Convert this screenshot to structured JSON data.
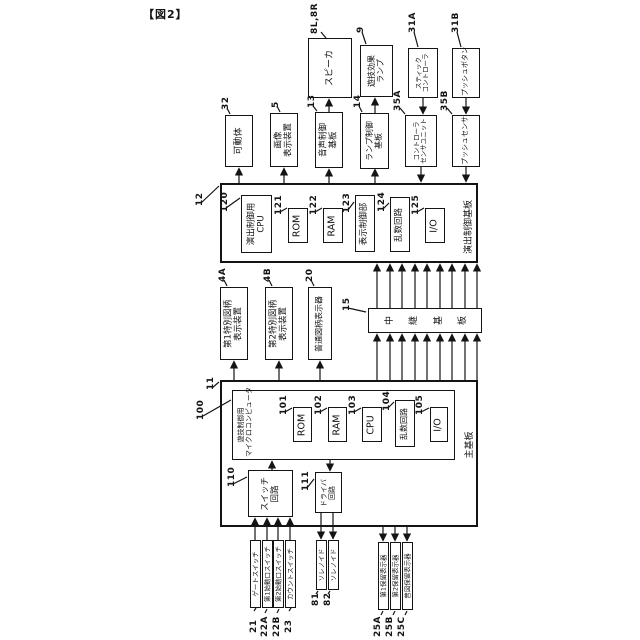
{
  "title": "【図2】",
  "colors": {
    "line": "#141414",
    "background": "#ffffff"
  },
  "diagram": {
    "boxes": [
      {
        "name": "effect-control-board",
        "ref": "12",
        "rx": 195,
        "ry": 206,
        "x": 220,
        "y": 183,
        "w": 258,
        "h": 80,
        "thick": true,
        "fs": 9
      },
      {
        "name": "main-board",
        "ref": "11",
        "rx": 206,
        "ry": 390,
        "x": 220,
        "y": 380,
        "w": 258,
        "h": 147,
        "thick": true,
        "fs": 9
      },
      {
        "name": "game-control-microcomputer",
        "ref": "100",
        "rx": 196,
        "ry": 420,
        "x": 232,
        "y": 390,
        "w": 223,
        "h": 70,
        "fs": 8
      },
      {
        "name": "speaker",
        "ref": "8L,8R",
        "rx": 310,
        "ry": 34,
        "x": 308,
        "y": 38,
        "w": 44,
        "h": 60,
        "fs": 9,
        "lines": [
          "スピーカ"
        ]
      },
      {
        "name": "game-effect-lamp",
        "ref": "9",
        "rx": 356,
        "ry": 33,
        "x": 360,
        "y": 45,
        "w": 33,
        "h": 52,
        "fs": 8,
        "lines": [
          "遊技効果",
          "ランプ"
        ]
      },
      {
        "name": "stick-controller",
        "ref": "31A",
        "rx": 408,
        "ry": 33,
        "x": 408,
        "y": 48,
        "w": 30,
        "h": 50,
        "fs": 6.5,
        "lines": [
          "スティック",
          "コントローラ"
        ]
      },
      {
        "name": "push-button",
        "ref": "31B",
        "rx": 451,
        "ry": 33,
        "x": 452,
        "y": 48,
        "w": 28,
        "h": 50,
        "fs": 7,
        "lines": [
          "プッシュボタン"
        ]
      },
      {
        "name": "movable-body",
        "ref": "32",
        "rx": 221,
        "ry": 110,
        "x": 225,
        "y": 115,
        "w": 28,
        "h": 52,
        "fs": 9,
        "lines": [
          "可動体"
        ]
      },
      {
        "name": "image-display-device",
        "ref": "5",
        "rx": 271,
        "ry": 108,
        "x": 270,
        "y": 113,
        "w": 28,
        "h": 54,
        "fs": 8.5,
        "lines": [
          "画像",
          "表示装置"
        ]
      },
      {
        "name": "sound-control-board",
        "ref": "13",
        "rx": 307,
        "ry": 108,
        "x": 315,
        "y": 112,
        "w": 28,
        "h": 56,
        "fs": 8.5,
        "lines": [
          "音声制御",
          "基板"
        ]
      },
      {
        "name": "lamp-control-board",
        "ref": "14",
        "rx": 353,
        "ry": 108,
        "x": 360,
        "y": 113,
        "w": 29,
        "h": 56,
        "fs": 8,
        "lines": [
          "ランプ制御",
          "基板"
        ]
      },
      {
        "name": "controller-sensor-unit",
        "ref": "35A",
        "rx": 393,
        "ry": 111,
        "x": 405,
        "y": 115,
        "w": 32,
        "h": 52,
        "fs": 6.5,
        "lines": [
          "コントローラ",
          "センサユニット"
        ]
      },
      {
        "name": "push-sensor",
        "ref": "35B",
        "rx": 440,
        "ry": 111,
        "x": 452,
        "y": 115,
        "w": 28,
        "h": 52,
        "fs": 7,
        "lines": [
          "プッシュセンサ"
        ]
      },
      {
        "name": "effect-control-cpu",
        "ref": "120",
        "rx": 220,
        "ry": 212,
        "x": 241,
        "y": 195,
        "w": 31,
        "h": 58,
        "fs": 8.5,
        "lines": [
          "演出制御用",
          "CPU"
        ]
      },
      {
        "name": "effect-rom",
        "ref": "121",
        "rx": 274,
        "ry": 215,
        "x": 288,
        "y": 208,
        "w": 20,
        "h": 35,
        "fs": 9.5,
        "lines": [
          "ROM"
        ]
      },
      {
        "name": "effect-ram",
        "ref": "122",
        "rx": 309,
        "ry": 215,
        "x": 323,
        "y": 208,
        "w": 20,
        "h": 35,
        "fs": 9.5,
        "lines": [
          "RAM"
        ]
      },
      {
        "name": "display-control-unit",
        "ref": "123",
        "rx": 342,
        "ry": 213,
        "x": 355,
        "y": 195,
        "w": 20,
        "h": 57,
        "fs": 8.5,
        "lines": [
          "表示制御部"
        ]
      },
      {
        "name": "effect-random-circuit",
        "ref": "124",
        "rx": 377,
        "ry": 212,
        "x": 390,
        "y": 197,
        "w": 20,
        "h": 55,
        "fs": 8.5,
        "lines": [
          "乱数回路"
        ]
      },
      {
        "name": "effect-io",
        "ref": "125",
        "rx": 411,
        "ry": 215,
        "x": 425,
        "y": 208,
        "w": 20,
        "h": 35,
        "fs": 9.5,
        "lines": [
          "I/O"
        ]
      },
      {
        "name": "special-symbol-display-1",
        "ref": "4A",
        "rx": 218,
        "ry": 282,
        "x": 220,
        "y": 287,
        "w": 28,
        "h": 73,
        "fs": 8.5,
        "lines": [
          "第1特別図柄",
          "表示装置"
        ]
      },
      {
        "name": "special-symbol-display-2",
        "ref": "4B",
        "rx": 263,
        "ry": 282,
        "x": 265,
        "y": 287,
        "w": 28,
        "h": 73,
        "fs": 8.5,
        "lines": [
          "第2特別図柄",
          "表示装置"
        ]
      },
      {
        "name": "normal-symbol-display",
        "ref": "20",
        "rx": 305,
        "ry": 282,
        "x": 308,
        "y": 287,
        "w": 24,
        "h": 73,
        "fs": 8,
        "lines": [
          "普通図柄表示器"
        ]
      },
      {
        "name": "relay-board",
        "ref": "15",
        "rx": 342,
        "ry": 311,
        "x": 368,
        "y": 308,
        "w": 114,
        "h": 25,
        "fs": 9,
        "mode": "chars",
        "lines": [
          "中継基板"
        ]
      },
      {
        "name": "main-rom",
        "ref": "101",
        "rx": 279,
        "ry": 415,
        "x": 293,
        "y": 407,
        "w": 19,
        "h": 35,
        "fs": 9.5,
        "lines": [
          "ROM"
        ]
      },
      {
        "name": "main-ram",
        "ref": "102",
        "rx": 314,
        "ry": 415,
        "x": 328,
        "y": 407,
        "w": 19,
        "h": 35,
        "fs": 9.5,
        "lines": [
          "RAM"
        ]
      },
      {
        "name": "main-cpu",
        "ref": "103",
        "rx": 348,
        "ry": 415,
        "x": 362,
        "y": 407,
        "w": 20,
        "h": 35,
        "fs": 9.5,
        "lines": [
          "CPU"
        ]
      },
      {
        "name": "main-random-circuit",
        "ref": "104",
        "rx": 382,
        "ry": 411,
        "x": 395,
        "y": 400,
        "w": 20,
        "h": 47,
        "fs": 8,
        "lines": [
          "乱数回路"
        ]
      },
      {
        "name": "main-io",
        "ref": "105",
        "rx": 415,
        "ry": 415,
        "x": 430,
        "y": 407,
        "w": 18,
        "h": 35,
        "fs": 9.5,
        "lines": [
          "I/O"
        ]
      },
      {
        "name": "switch-circuit",
        "ref": "110",
        "rx": 227,
        "ry": 487,
        "x": 248,
        "y": 470,
        "w": 45,
        "h": 47,
        "fs": 8.5,
        "lines": [
          "スイッチ",
          "回路"
        ]
      },
      {
        "name": "driver-circuit",
        "ref": "111",
        "rx": 301,
        "ry": 491,
        "x": 315,
        "y": 472,
        "w": 27,
        "h": 41,
        "fs": 7,
        "lines": [
          "ドライバ",
          "回路"
        ]
      },
      {
        "name": "gate-switch",
        "ref": "21",
        "rx": 249,
        "ry": 633,
        "x": 250,
        "y": 540,
        "w": 11,
        "h": 68,
        "thin": true,
        "fs": 6.5,
        "lines": [
          "ゲートスイッチ"
        ]
      },
      {
        "name": "start-switch-1",
        "ref": "22A",
        "rx": 260,
        "ry": 637,
        "x": 262,
        "y": 540,
        "w": 11,
        "h": 68,
        "thin": true,
        "fs": 6.5,
        "lines": [
          "第1始動口スイッチ"
        ]
      },
      {
        "name": "start-switch-2",
        "ref": "22B",
        "rx": 272,
        "ry": 637,
        "x": 273,
        "y": 540,
        "w": 11,
        "h": 68,
        "thin": true,
        "fs": 6.5,
        "lines": [
          "第2始動口スイッチ"
        ]
      },
      {
        "name": "count-switch",
        "ref": "23",
        "rx": 284,
        "ry": 633,
        "x": 285,
        "y": 540,
        "w": 11,
        "h": 68,
        "thin": true,
        "fs": 6.5,
        "lines": [
          "カウントスイッチ"
        ]
      },
      {
        "name": "solenoid-1",
        "ref": "81",
        "rx": 311,
        "ry": 606,
        "x": 316,
        "y": 540,
        "w": 11,
        "h": 50,
        "thin": true,
        "fs": 6.5,
        "lines": [
          "ソレノイド"
        ]
      },
      {
        "name": "solenoid-2",
        "ref": "82",
        "rx": 323,
        "ry": 606,
        "x": 328,
        "y": 540,
        "w": 11,
        "h": 50,
        "thin": true,
        "fs": 6.5,
        "lines": [
          "ソレノイド"
        ]
      },
      {
        "name": "hold-display-1",
        "ref": "25A",
        "rx": 373,
        "ry": 637,
        "x": 378,
        "y": 542,
        "w": 11,
        "h": 68,
        "thin": true,
        "fs": 6.5,
        "lines": [
          "第1保留表示器"
        ]
      },
      {
        "name": "hold-display-2",
        "ref": "25B",
        "rx": 385,
        "ry": 637,
        "x": 390,
        "y": 542,
        "w": 11,
        "h": 68,
        "thin": true,
        "fs": 6.5,
        "lines": [
          "第2保留表示器"
        ]
      },
      {
        "name": "hold-display-3",
        "ref": "25C",
        "rx": 397,
        "ry": 637,
        "x": 402,
        "y": 542,
        "w": 11,
        "h": 68,
        "thin": true,
        "fs": 6.5,
        "lines": [
          "普図保留表示器"
        ]
      }
    ],
    "labels": [
      {
        "name": "effect-control-board-name",
        "x": 461,
        "y": 196,
        "w": 16,
        "h": 62,
        "fs": 9,
        "lines": [
          "演出制御基板"
        ]
      },
      {
        "name": "main-board-name",
        "x": 463,
        "y": 426,
        "w": 14,
        "h": 38,
        "fs": 9,
        "lines": [
          "主基板"
        ]
      },
      {
        "name": "microcomputer-name",
        "x": 234,
        "y": 391,
        "w": 24,
        "h": 68,
        "fs": 7,
        "lines": [
          "遊技制御用",
          "マイクロコンピュータ"
        ]
      }
    ],
    "lines": [
      [
        329,
        112,
        329,
        100,
        1
      ],
      [
        375,
        113,
        375,
        99,
        1
      ],
      [
        423,
        98,
        423,
        113,
        1
      ],
      [
        466,
        98,
        466,
        113,
        1
      ],
      [
        239,
        183,
        239,
        169,
        1
      ],
      [
        284,
        183,
        284,
        169,
        1
      ],
      [
        329,
        183,
        329,
        170,
        1
      ],
      [
        375,
        183,
        375,
        170,
        1
      ],
      [
        421,
        167,
        421,
        181,
        1
      ],
      [
        466,
        167,
        466,
        181,
        1
      ],
      [
        234,
        380,
        234,
        362,
        1
      ],
      [
        279,
        380,
        279,
        362,
        1
      ],
      [
        320,
        380,
        320,
        362,
        1
      ],
      [
        377,
        308,
        377,
        265,
        1
      ],
      [
        390,
        308,
        390,
        265,
        1
      ],
      [
        402,
        308,
        402,
        265,
        1
      ],
      [
        415,
        308,
        415,
        265,
        1
      ],
      [
        427,
        308,
        427,
        265,
        1
      ],
      [
        440,
        308,
        440,
        265,
        1
      ],
      [
        452,
        308,
        452,
        265,
        1
      ],
      [
        465,
        308,
        465,
        265,
        1
      ],
      [
        477,
        308,
        477,
        265,
        1
      ],
      [
        377,
        380,
        377,
        335,
        1
      ],
      [
        390,
        380,
        390,
        335,
        1
      ],
      [
        402,
        380,
        402,
        335,
        1
      ],
      [
        415,
        380,
        415,
        335,
        1
      ],
      [
        427,
        380,
        427,
        335,
        1
      ],
      [
        440,
        380,
        440,
        335,
        1
      ],
      [
        452,
        380,
        452,
        335,
        1
      ],
      [
        465,
        380,
        465,
        335,
        1
      ],
      [
        477,
        380,
        477,
        335,
        1
      ],
      [
        272,
        470,
        272,
        462,
        1
      ],
      [
        330,
        460,
        330,
        470,
        1
      ],
      [
        255,
        540,
        255,
        519,
        1
      ],
      [
        267,
        540,
        267,
        519,
        1
      ],
      [
        278,
        540,
        278,
        519,
        1
      ],
      [
        290,
        540,
        290,
        519,
        1
      ],
      [
        321,
        513,
        321,
        538,
        1
      ],
      [
        333,
        513,
        333,
        538,
        1
      ],
      [
        383,
        527,
        383,
        540,
        1
      ],
      [
        395,
        527,
        395,
        540,
        1
      ],
      [
        407,
        527,
        407,
        540,
        1
      ],
      [
        321,
        32,
        326,
        38,
        0
      ],
      [
        362,
        32,
        366,
        44,
        0
      ],
      [
        414,
        32,
        418,
        47,
        0
      ],
      [
        457,
        32,
        461,
        47,
        0
      ],
      [
        227,
        108,
        230,
        114,
        0
      ],
      [
        277,
        106,
        280,
        112,
        0
      ],
      [
        313,
        106,
        317,
        111,
        0
      ],
      [
        359,
        106,
        362,
        112,
        0
      ],
      [
        400,
        108,
        405,
        114,
        0
      ],
      [
        447,
        108,
        452,
        114,
        0
      ],
      [
        201,
        203,
        219,
        186,
        0
      ],
      [
        226,
        208,
        240,
        198,
        0
      ],
      [
        280,
        212,
        287,
        208,
        0
      ],
      [
        315,
        212,
        322,
        208,
        0
      ],
      [
        348,
        210,
        354,
        202,
        0
      ],
      [
        383,
        209,
        389,
        203,
        0
      ],
      [
        417,
        212,
        424,
        208,
        0
      ],
      [
        224,
        280,
        227,
        286,
        0
      ],
      [
        269,
        280,
        272,
        286,
        0
      ],
      [
        311,
        280,
        314,
        286,
        0
      ],
      [
        348,
        308,
        366,
        312,
        0
      ],
      [
        212,
        388,
        219,
        382,
        0
      ],
      [
        203,
        416,
        231,
        400,
        0
      ],
      [
        285,
        412,
        292,
        408,
        0
      ],
      [
        320,
        412,
        327,
        408,
        0
      ],
      [
        354,
        412,
        361,
        408,
        0
      ],
      [
        388,
        408,
        394,
        402,
        0
      ],
      [
        421,
        412,
        429,
        408,
        0
      ],
      [
        233,
        484,
        247,
        477,
        0
      ],
      [
        307,
        488,
        314,
        479,
        0
      ],
      [
        254,
        611,
        256,
        608,
        0
      ],
      [
        265,
        613,
        267,
        609,
        0
      ],
      [
        277,
        613,
        279,
        609,
        0
      ],
      [
        289,
        611,
        291,
        608,
        0
      ],
      [
        316,
        594,
        318,
        591,
        0
      ],
      [
        328,
        594,
        330,
        591,
        0
      ],
      [
        381,
        615,
        383,
        611,
        0
      ],
      [
        393,
        615,
        395,
        611,
        0
      ],
      [
        405,
        615,
        407,
        611,
        0
      ]
    ]
  }
}
